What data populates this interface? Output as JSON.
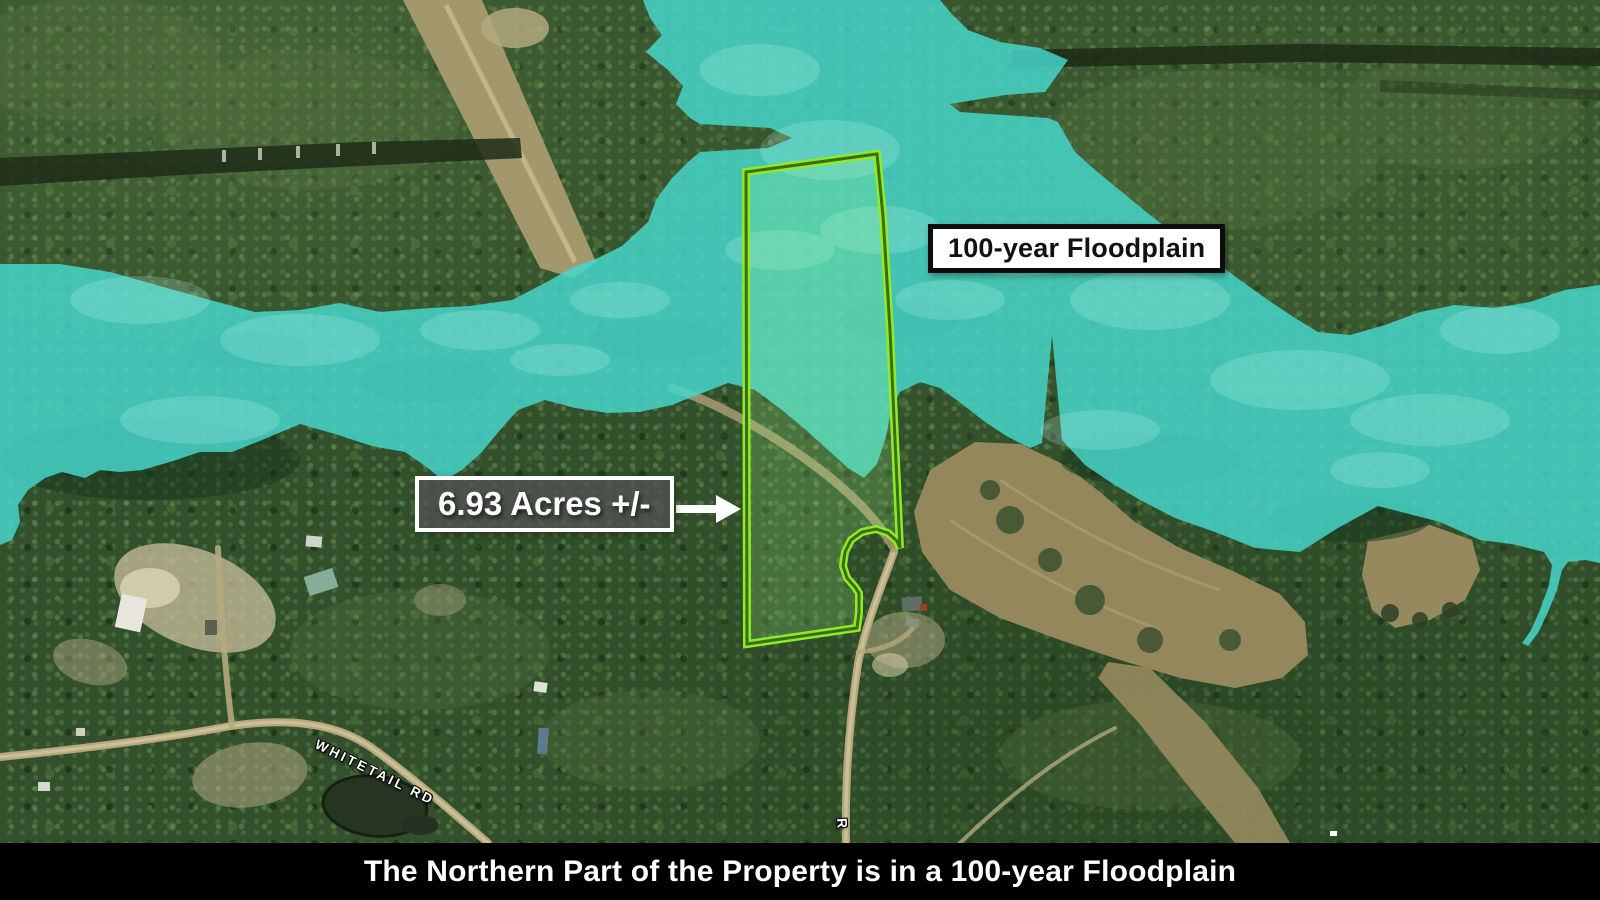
{
  "labels": {
    "floodplain": "100-year Floodplain",
    "acreage": "6.93 Acres +/-",
    "caption": "The Northern Part of the Property is in a 100-year Floodplain",
    "road_whitetail": "WHITETAIL RD",
    "road_r": "R"
  },
  "colors": {
    "floodplain_overlay": "#46D7CC",
    "property_line": "#8DEB28",
    "property_fill": "rgba(170,255,140,0.20)",
    "caption_bg": "#000000",
    "caption_text": "#FFFFFF",
    "floodplain_label_bg": "#FFFFFF",
    "floodplain_label_text": "#111111",
    "acreage_label_bg": "rgba(82,82,82,0.78)",
    "acreage_label_border": "#FFFFFF"
  },
  "map_type": "satellite-aerial"
}
